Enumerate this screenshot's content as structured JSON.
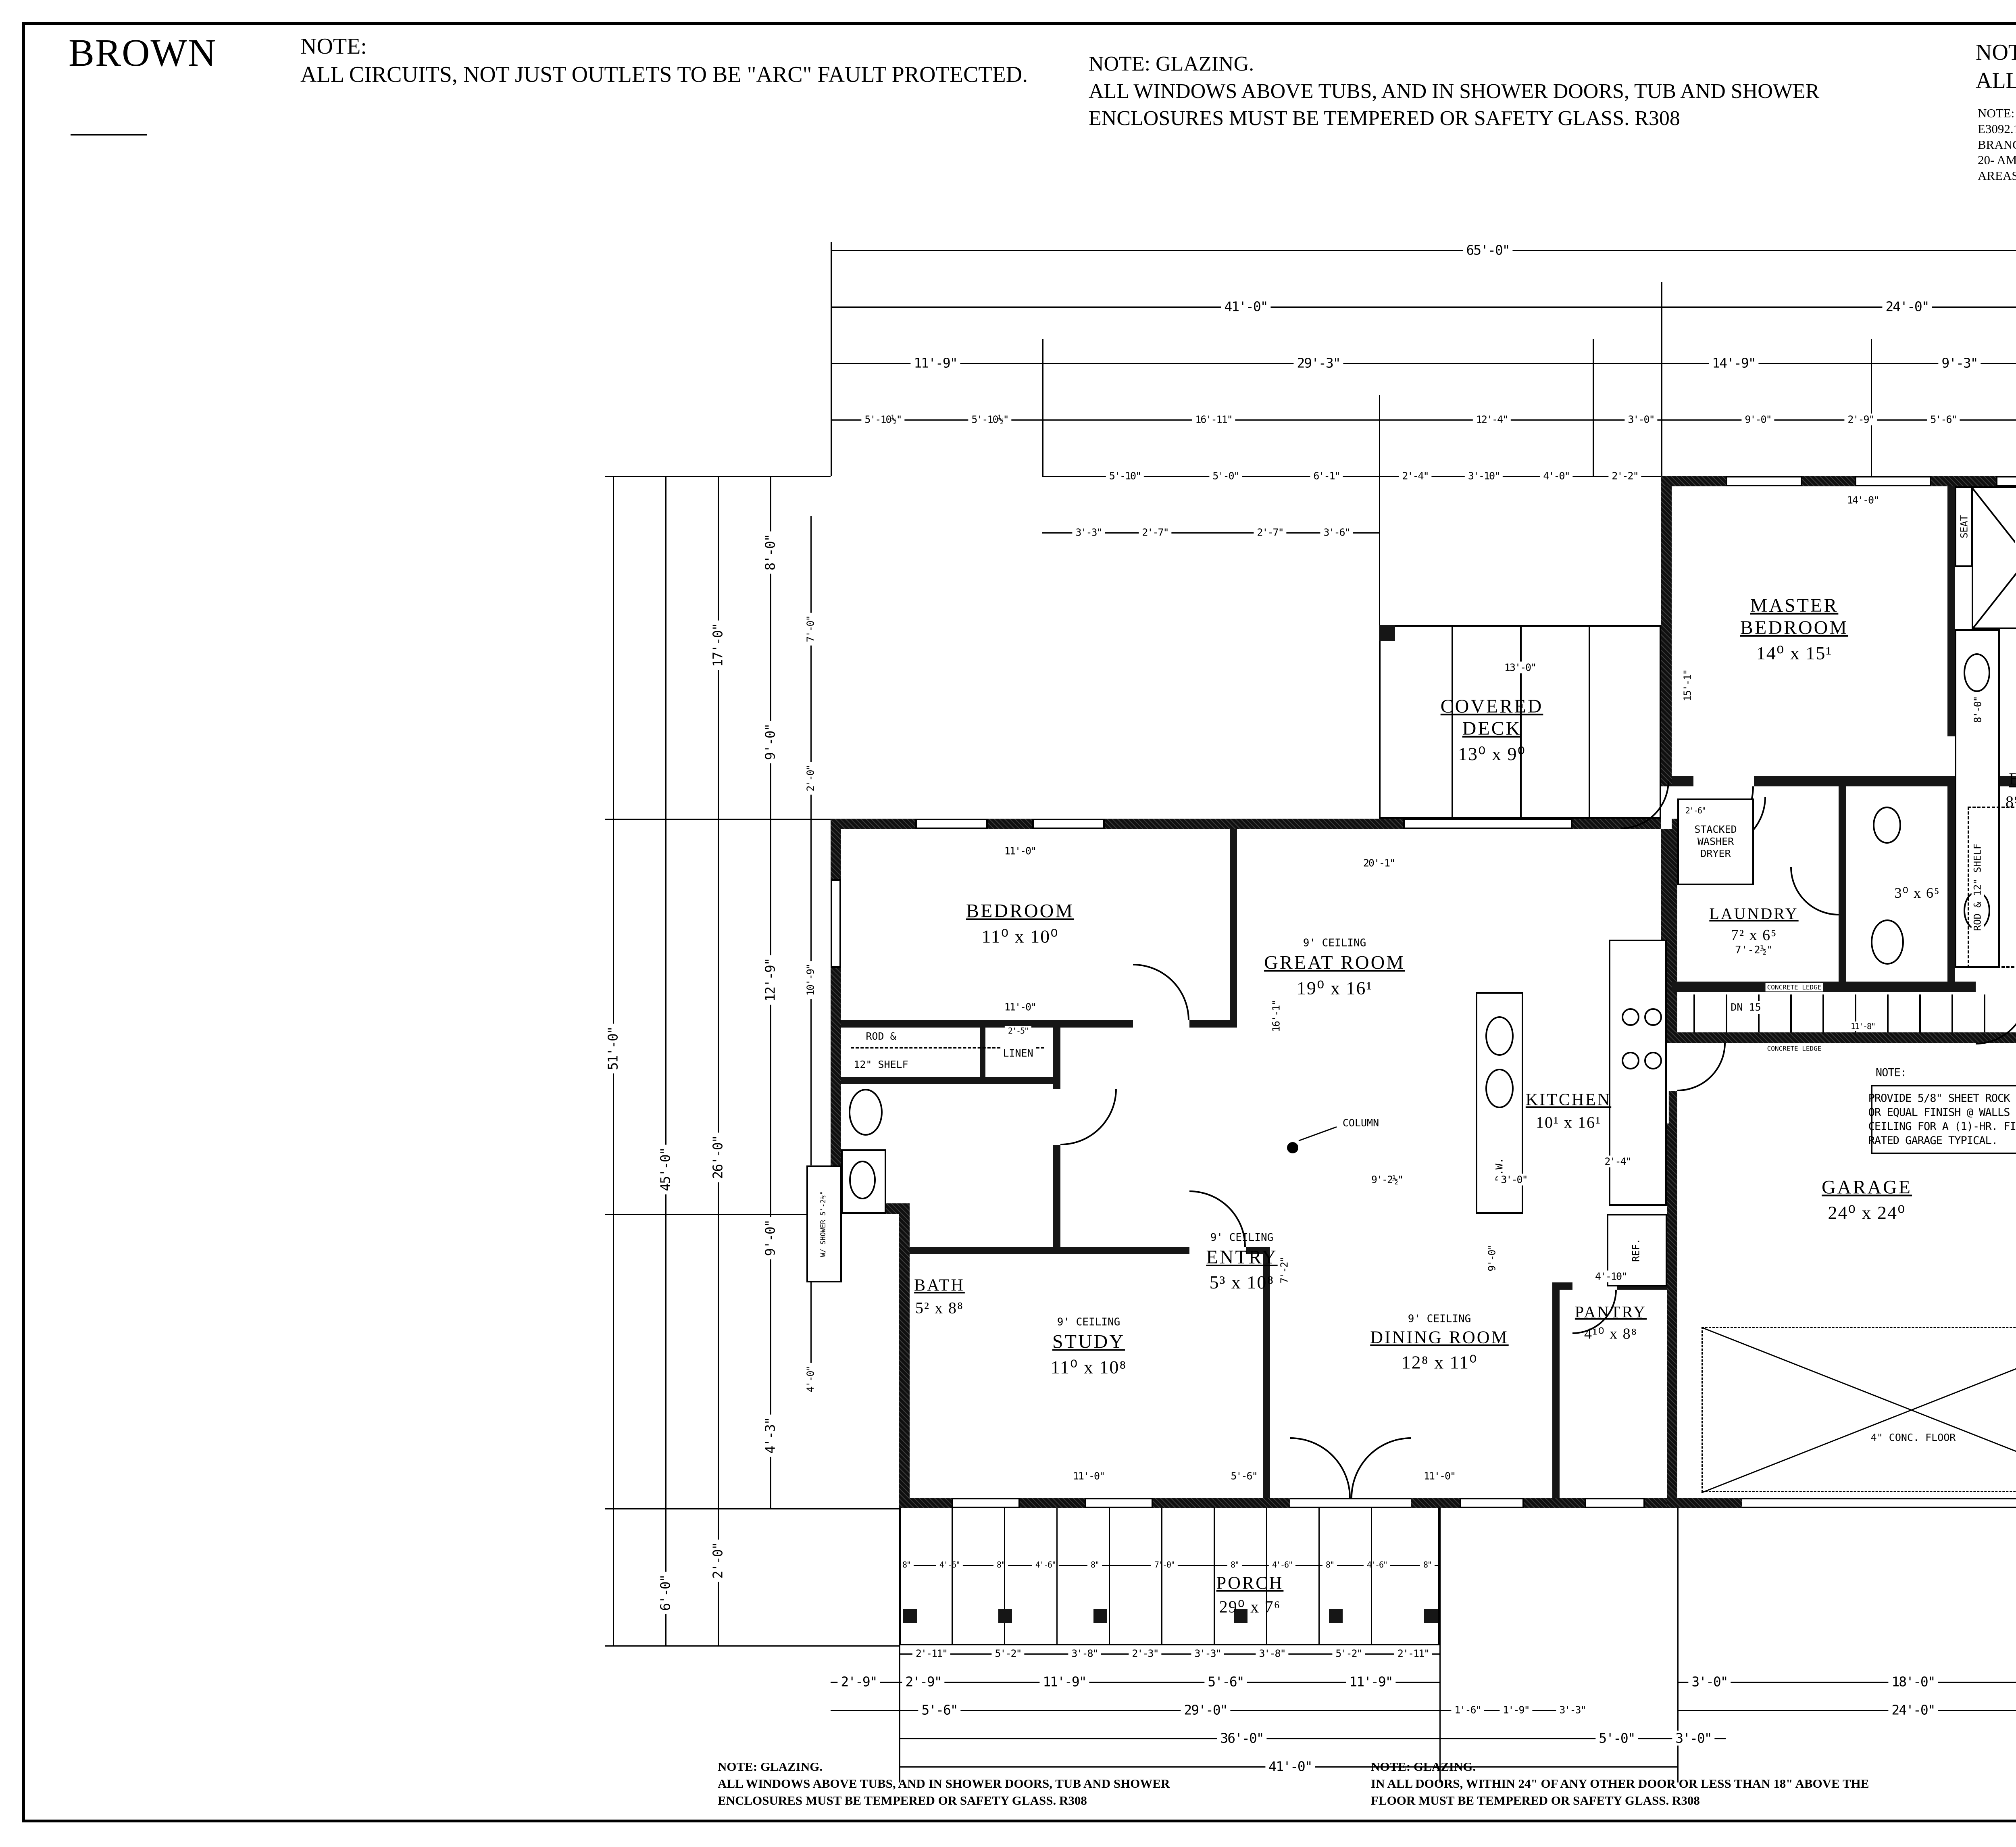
{
  "header": {
    "client": "BROWN"
  },
  "notes": {
    "tl": {
      "title": "NOTE:",
      "body": "ALL CIRCUITS, NOT JUST OUTLETS TO BE \"ARC\" FAULT PROTECTED."
    },
    "tm": {
      "l1": "NOTE: GLAZING.",
      "l2": "ALL WINDOWS ABOVE TUBS, AND IN SHOWER DOORS, TUB AND SHOWER",
      "l3": "ENCLOSURES MUST BE TEMPERED OR SAFETY GLASS.  R308"
    },
    "tr": {
      "title": "NOTE:",
      "body": "ALL ELECTRICAL RECEPTACLES ARE TO BE TAMPER PROOF TYPE"
    },
    "tr2": {
      "title": "NOTE:",
      "l1": "E3092.16 ARC-FAULT CIRCUIT-INTERRUPTER PROTECTION.",
      "l2": "BRANCH CIRCUITS THAT SUPPLY 120-VOLT, SINGLE-PHASE, 15- &",
      "l3": "20- AMP OUTLETS INSTALLED IN KITCHENS, BEDROOMS, LAUNDRY",
      "l4": "AREAS SHALL BE PROTECTED BY (AFCI AS DEFINED IN THE IRC SECTION)."
    },
    "bl": {
      "l1": "NOTE: GLAZING.",
      "l2": "ALL WINDOWS ABOVE TUBS, AND IN SHOWER DOORS, TUB AND SHOWER",
      "l3": "ENCLOSURES MUST BE TEMPERED OR SAFETY GLASS.  R308"
    },
    "bm": {
      "l1": "NOTE: GLAZING.",
      "l2": "IN ALL DOORS, WITHIN 24\" OF ANY OTHER DOOR OR LESS THAN 18\" ABOVE THE",
      "l3": "FLOOR MUST BE TEMPERED OR SAFETY GLASS.  R308"
    },
    "br": {
      "title": "NOTE:",
      "body": "2\"x6\" EXTERIOR WALLS"
    }
  },
  "footer": {
    "plan_title": "9'  MAIN FLOOR PLAN",
    "sqft_label": "SQ. FT.",
    "sqft": "1677",
    "scale_label": "SCALE: 1/4\" = 1'-0\"",
    "sqft2": "1785"
  },
  "plan": {
    "rooms": [
      {
        "name": "MASTER\nBEDROOM",
        "size": "14⁰ x 15¹"
      },
      {
        "name": "BATH",
        "size": "8⁹ x 15¹"
      },
      {
        "name": "W.I.C.",
        "size": "8⁴ x 6⁵"
      },
      {
        "name": "LAUNDRY",
        "size": "7² x 6⁵",
        "extra": "7'-2½\""
      },
      {
        "name": "",
        "size": "3⁰ x 6⁵"
      },
      {
        "name": "BEDROOM",
        "size": "11⁰ x 10⁰"
      },
      {
        "name": "GREAT  ROOM",
        "size": "19⁰ x 16¹",
        "ceil": "9' CEILING"
      },
      {
        "name": "COVERED\nDECK",
        "size": "13⁰ x 9⁰"
      },
      {
        "name": "KITCHEN",
        "size": "10¹ x 16¹"
      },
      {
        "name": "BATH",
        "size": "5² x 8⁸"
      },
      {
        "name": "STUDY",
        "size": "11⁰ x 10⁸",
        "ceil": "9' CEILING"
      },
      {
        "name": "ENTRY",
        "size": "5³ x 10⁸",
        "ceil": "9' CEILING"
      },
      {
        "name": "DINING  ROOM",
        "size": "12⁸ x 11⁰",
        "ceil": "9' CEILING"
      },
      {
        "name": "PANTRY",
        "size": "4¹⁰ x 8⁸"
      },
      {
        "name": "GARAGE",
        "size": "24⁰ x 24⁰"
      },
      {
        "name": "PORCH",
        "size": "29⁰ x 7⁶"
      }
    ],
    "garage_note": {
      "title": "NOTE:",
      "body": "PROVIDE 5/8\" SHEET ROCK\nOR EQUAL FINISH @ WALLS &\nCEILING FOR A (1)-HR. FIRE\nRATED GARAGE TYPICAL."
    },
    "ann": {
      "seat": "SEAT",
      "tub": "FREE STANDING TUB",
      "swd": "STACKED\nWASHER\nDRYER",
      "rod": "ROD &",
      "shelf": "12\" SHELF",
      "rodshelf": "ROD & 12\" SHELF",
      "linen": "LINEN",
      "dw": "D.W.",
      "ref": "REF.",
      "column": "COLUMN",
      "dn": "DN 15",
      "ledge": "CONCRETE LEDGE",
      "dutch": "DUTCH DOOR 2'-8\"",
      "slope": "SLOPE",
      "conc": "4\" CONC. FLOOR",
      "wshower": "W/ SHOWER\n5'-2½\"",
      "openshelves": "OPEN SHELVES"
    },
    "dims": {
      "top": [
        "65'-0\"",
        "41'-0\"",
        "24'-0\"",
        "11'-9\"",
        "29'-3\"",
        "14'-9\"",
        "9'-3\"",
        "5'-10½\"",
        "5'-10½\"",
        "16'-11\"",
        "12'-4\"",
        "3'-0\"",
        "9'-0\"",
        "2'-9\"",
        "5'-6\"",
        "3'-9\"",
        "5'-10\"",
        "5'-0\"",
        "6'-1\"",
        "2'-4\"",
        "3'-10\"",
        "4'-0\"",
        "2'-2\"",
        "3'-3\"",
        "2'-7\"",
        "2'-7\"",
        "3'-6\""
      ],
      "left": [
        "51'-0\"",
        "45'-0\"",
        "6'-0\"",
        "17'-0\"",
        "26'-0\"",
        "2'-0\"",
        "8'-0\"",
        "9'-0\"",
        "12'-9\"",
        "9'-0\"",
        "4'-3\"",
        "7'-0\"",
        "2'-0\"",
        "10'-9\"",
        "2'-0\"",
        "5'-0\"",
        "4'-0\""
      ],
      "right": [
        "51'-0\"",
        "27'-0\"",
        "24'-0\"",
        "16'-2\"",
        "10'-0\"",
        "6'-2\"",
        "6'-4½\"",
        "4'-5½\"",
        "7'-0\"",
        "7'-0\"",
        "10'-0\"",
        "2'-8\""
      ],
      "bottom": [
        "8\"",
        "4'-6\"",
        "8\"",
        "4'-6\"",
        "8\"",
        "7'-0\"",
        "8\"",
        "4'-6\"",
        "8\"",
        "4'-6\"",
        "8\"",
        "2'-11\"",
        "5'-2\"",
        "3'-8\"",
        "2'-3\"",
        "3'-3\"",
        "3'-8\"",
        "5'-2\"",
        "2'-11\"",
        "2'-9\"",
        "2'-9\"",
        "11'-9\"",
        "5'-6\"",
        "11'-9\"",
        "5'-6\"",
        "29'-0\"",
        "1'-6\"",
        "1'-9\"",
        "3'-3\"",
        "36'-0\"",
        "5'-0\"",
        "3'-0\"",
        "41'-0\"",
        "3'-0\"",
        "18'-0\"",
        "3'-0\"",
        "24'-0\""
      ],
      "inner": [
        "14'-0\"",
        "15'-1\"",
        "8'-0\"",
        "3'-7½\"",
        "13'-0\"",
        "20'-1\"",
        "16'-1\"",
        "11'-0\"",
        "11'-0\"",
        "9'-2½\"",
        "3'-0\"",
        "2'-4\"",
        "4'-10\"",
        "11'-0\"",
        "5'-6\"",
        "11'-0\"",
        "24'-0\"",
        "11'-8\"",
        "2'-6\"",
        "7'-2\"",
        "9'-0\"",
        "2'-5\""
      ]
    }
  },
  "titleblock": {
    "disclaimer": "THE UTMOST CARE HAS BEEN TAKEN IN THE PREPARATION OF THESE PLANS, HOWEVER, THE PREPARER ASSUMES NO FINANCIAL LIABILITY RESULTING FROM ERRORS IN THESE PLANS. THESE PLANS ARE NOT ALL-INCLUSIVE OF LOCAL AND STATE BUILDING CODES. IT IS THE BUILDING CONTRACTOR'S RESPONSIBILITY TO CHECK THESE PLANS CAREFULLY BEFORE CONSTRUCTION AND TO BUILD THE STRUCTURE IN COMPLIANCE WITH ALL APPLICABLE CODES AND ORDINANCES.",
    "plan_drawn_for": "PLAN DRAWN FOR",
    "client": "BROWN",
    "copyright": {
      "brand": "© JL HOME DESIGN",
      "body": "COPYRIGHT 2003 JL HOME DESIGN\nTHESE PLANS, DRAWINGS & ELEVATIONS\nARE SOLD FOR USE IN THE CONSTRUCTION\nOF ONE DWELLING ONLY. ON ________\nFOR BROWN\nREUSE, REPRODUCTION OR PUBLICATION\nBY ANY METHOD, IN WHOLE OR IN PART,\nIS PROHIBITED."
    },
    "designer": {
      "name": "JARED LESSER",
      "cell": "CELL 787-9004",
      "tagline": "CUSTOM HOME DESIGN",
      "rate": "$.50 SQ. FT.",
      "monogram": "JL",
      "banner": "HOME DESIGN"
    },
    "sheetinfo": {
      "title": "MAIN FLOOR PLAN",
      "sqft_label": "SQ. FT:",
      "scale_label": "SCALE",
      "scale_value": "1/4\" = 1'-0\"",
      "ruler_label": "RULER",
      "t0": "0",
      "t1": "1'",
      "t2": "2'",
      "t4": "4'"
    },
    "meta": {
      "plan": "PLAN:  BROWN",
      "date_label": "DATE:",
      "date": "11.21.24"
    },
    "areas": {
      "l0": "LOFT SQ. FT.:",
      "v0": "NA",
      "l1": "MAIN. SQ. FT.:",
      "v1": "1677",
      "l2": "BASEMENT. SQ. FT.:",
      "v2": "1664",
      "l3": "TOTAL SQ. FEET",
      "v3": "3341"
    },
    "page": {
      "label": "Page:",
      "number": "4",
      "of": "of ."
    }
  }
}
